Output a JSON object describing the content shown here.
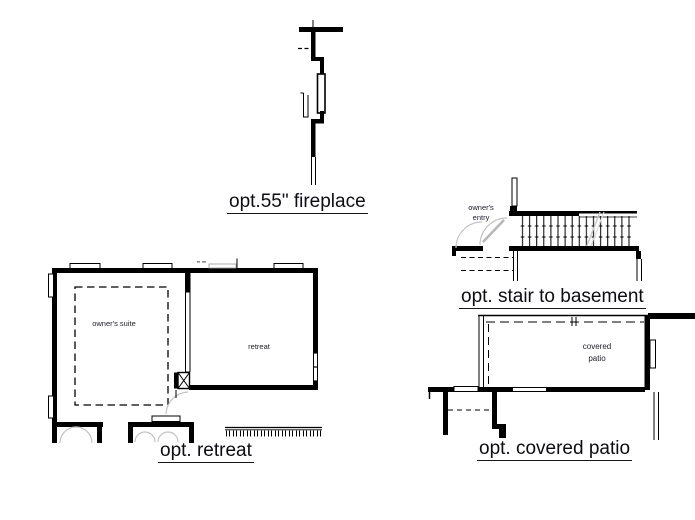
{
  "sheet": {
    "background": "#ffffff",
    "ink_color": "#000000",
    "door_swing_color": "#c3c3c3",
    "faint_mark_color": "#9a9a9a"
  },
  "figures": {
    "fireplace": {
      "caption": "opt.55\" fireplace"
    },
    "stair_basement": {
      "caption": "opt. stair to basement",
      "room_label": "owner's\nentry"
    },
    "retreat": {
      "caption": "opt. retreat",
      "room_labels": {
        "owners_suite": "owner's suite",
        "retreat": "retreat"
      }
    },
    "covered_patio": {
      "caption": "opt. covered patio",
      "room_label": "covered\npatio"
    }
  }
}
